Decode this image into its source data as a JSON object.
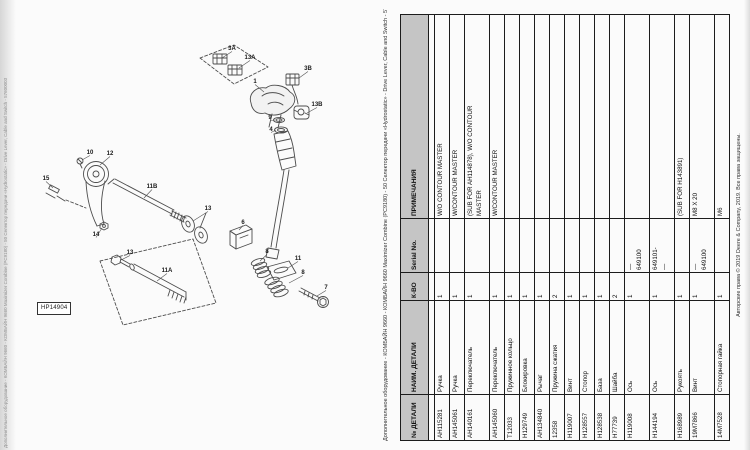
{
  "page": {
    "catalog_title": "Дополнительное оборудование - КОМБАЙН 9660 - КОМБАЙН 9660 Maximizer Combine (PC9180) - 50 Селектор передачи «Hydrostatic» - Drive Lever, Cable and Switch - 57600003",
    "copyright": "Авторские права © 2019 Deere & Company, 2019. Все права защищены.",
    "figure_label": "HP14904"
  },
  "diagram": {
    "callouts": [
      {
        "label": "3A",
        "x": 232,
        "y": 50,
        "lx": 222,
        "ly": 58
      },
      {
        "label": "13A",
        "x": 250,
        "y": 59,
        "lx": 239,
        "ly": 68
      },
      {
        "label": "1",
        "x": 255,
        "y": 83,
        "lx": 264,
        "ly": 92
      },
      {
        "label": "3B",
        "x": 308,
        "y": 70,
        "lx": 299,
        "ly": 78
      },
      {
        "label": "13B",
        "x": 317,
        "y": 106,
        "lx": 307,
        "ly": 113
      },
      {
        "label": "9",
        "x": 270,
        "y": 119,
        "lx": 275,
        "ly": 120
      },
      {
        "label": "4",
        "x": 271,
        "y": 131,
        "lx": 276,
        "ly": 130
      },
      {
        "label": "10",
        "x": 90,
        "y": 154,
        "lx": 82,
        "ly": 160
      },
      {
        "label": "12",
        "x": 110,
        "y": 155,
        "lx": 100,
        "ly": 165
      },
      {
        "label": "15",
        "x": 46,
        "y": 180,
        "lx": 53,
        "ly": 188
      },
      {
        "label": "11B",
        "x": 152,
        "y": 188,
        "lx": 144,
        "ly": 198
      },
      {
        "label": "14",
        "x": 96,
        "y": 236,
        "lx": 102,
        "ly": 228
      },
      {
        "label": "13",
        "x": 208,
        "y": 210,
        "lx": 193,
        "ly": 221
      },
      {
        "label": "13",
        "x": 130,
        "y": 254,
        "lx": 121,
        "ly": 260
      },
      {
        "label": "11A",
        "x": 167,
        "y": 272,
        "lx": 157,
        "ly": 281
      },
      {
        "label": "6",
        "x": 243,
        "y": 224,
        "lx": 239,
        "ly": 230
      },
      {
        "label": "8",
        "x": 267,
        "y": 253,
        "lx": 260,
        "ly": 261
      },
      {
        "label": "11",
        "x": 298,
        "y": 260,
        "lx": 288,
        "ly": 268
      },
      {
        "label": "8",
        "x": 303,
        "y": 274,
        "lx": 289,
        "ly": 283
      },
      {
        "label": "7",
        "x": 326,
        "y": 289,
        "lx": 317,
        "ly": 296
      }
    ]
  },
  "table": {
    "headers": [
      "№ ДЕТАЛИ",
      "НАИМ. ДЕТАЛИ",
      "К-ВО",
      "Serial No.",
      "ПРИМЕЧАНИЯ"
    ],
    "rows": [
      [
        "AH115281",
        "Ручка",
        "1",
        "",
        "W/O CONTOUR MASTER"
      ],
      [
        "AH145061",
        "Ручка",
        "1",
        "",
        "W/CONTOUR MASTER"
      ],
      [
        "AH140161",
        "Переключатель",
        "1",
        "",
        "(SUB FOR AH114878), W/O CONTOUR\nMASTER"
      ],
      [
        "AH145060",
        "Переключатель",
        "1",
        "",
        "W/CONTOUR MASTER"
      ],
      [
        "T12033",
        "Пружинное кольцо",
        "1",
        "",
        ""
      ],
      [
        "H129749",
        "Блокировка",
        "1",
        "",
        ""
      ],
      [
        "AH134840",
        "Рычаг",
        "1",
        "",
        ""
      ],
      [
        "12358",
        "Пружина сжатия",
        "2",
        "",
        ""
      ],
      [
        "H119007",
        "Винт",
        "1",
        "",
        ""
      ],
      [
        "H128557",
        "Стопор",
        "1",
        "",
        ""
      ],
      [
        "H128538",
        "База",
        "1",
        "",
        ""
      ],
      [
        "H77739",
        "Шайба",
        "2",
        "",
        ""
      ],
      [
        "H119008",
        "Ось",
        "1",
        "—\n649100",
        ""
      ],
      [
        "H144194",
        "Ось",
        "1",
        "649101-\n—",
        ""
      ],
      [
        "H168989",
        "Рукоять",
        "1",
        "",
        "(SUB FOR H143891)"
      ],
      [
        "19M7866",
        "Винт",
        "1",
        "—\n649100",
        "M8 X 20"
      ],
      [
        "14M7528",
        "Стопорная гайка",
        "1",
        "",
        "M6"
      ]
    ]
  }
}
